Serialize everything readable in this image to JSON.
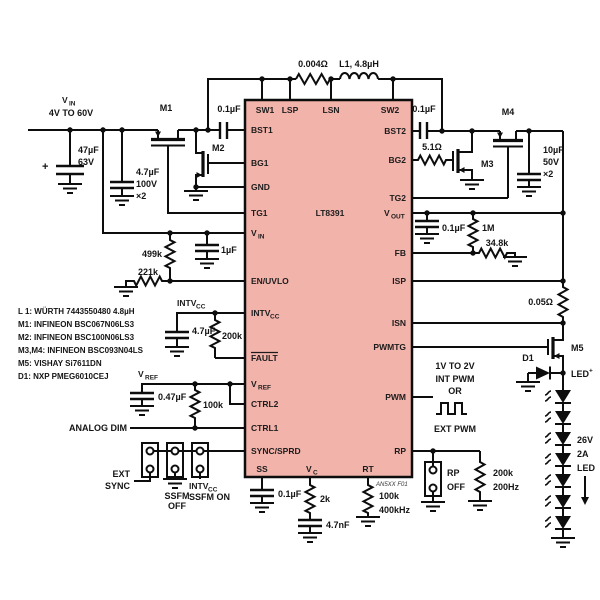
{
  "ic": {
    "part": "LT8391",
    "fig_ref": "AN5XX F01"
  },
  "pins": {
    "sw1": "SW1",
    "lsp": "LSP",
    "lsn": "LSN",
    "sw2": "SW2",
    "bst1": "BST1",
    "bg1": "BG1",
    "gnd": "GND",
    "tg1": "TG1",
    "vin": {
      "main": "V",
      "sub": "IN"
    },
    "en_uvlo": "EN/UVLO",
    "intvcc": {
      "main": "INTV",
      "sub": "CC"
    },
    "fault": "FAULT",
    "vref": {
      "main": "V",
      "sub": "REF"
    },
    "ctrl2": "CTRL2",
    "ctrl1": "CTRL1",
    "sync_sprd": "SYNC/SPRD",
    "ss": "SS",
    "vc": {
      "main": "V",
      "sub": "C"
    },
    "rt": "RT",
    "bst2": "BST2",
    "bg2": "BG2",
    "tg2": "TG2",
    "vout": {
      "main": "V",
      "sub": "OUT"
    },
    "fb": "FB",
    "isp": "ISP",
    "isn": "ISN",
    "pwmtg": "PWMTG",
    "pwm": "PWM",
    "rp": "RP"
  },
  "input": {
    "label": {
      "main": "V",
      "sub": "IN"
    },
    "range": "4V TO 60V"
  },
  "values": {
    "c_in_bulk": "47µF",
    "c_in_bulk_v": "63V",
    "c_in_bulk_plus": "+",
    "c_in_cer": "4.7µF",
    "c_in_cer_v": "100V",
    "c_in_cer_qty": "×2",
    "c_bst1": "0.1µF",
    "r_ind": "0.004Ω",
    "l1": "L1, 4.8µH",
    "c_bst2": "0.1µF",
    "r_bg2": "5.1Ω",
    "c_out": "10µF",
    "c_out_v": "50V",
    "c_out_qty": "×2",
    "r_en_top": "499k",
    "r_en_bot": "221k",
    "c_vin": "1µF",
    "c_intvcc": "4.7µF",
    "r_fault": "200k",
    "c_vref": "0.47µF",
    "r_ctrl": "100k",
    "c_vout": "0.1µF",
    "r_fb_top": "1M",
    "r_fb_bot": "34.8k",
    "r_isense": "0.05Ω",
    "c_ss": "0.1µF",
    "r_vc": "2k",
    "c_vc": "4.7nF",
    "r_rt": "100k",
    "r_rt_f": "400kHz",
    "r_rp": "200k",
    "r_rp_f": "200Hz"
  },
  "devices": {
    "m1": "M1",
    "m2": "M2",
    "m3": "M3",
    "m4": "M4",
    "m5": "M5",
    "d1": "D1"
  },
  "annotations": {
    "intvcc_node": {
      "main": "INTV",
      "sub": "CC"
    },
    "vref_node": {
      "main": "V",
      "sub": "REF"
    },
    "analog_dim": "ANALOG DIM",
    "ext_sync": [
      "EXT",
      "SYNC"
    ],
    "ssfm_off": [
      "SSFM",
      "OFF"
    ],
    "intvcc_jumper": {
      "main": "INTV",
      "sub": "CC"
    },
    "ssfm_on": "SSFM ON",
    "pwm_note": [
      "1V TO 2V",
      "INT PWM",
      "OR",
      "EXT PWM"
    ],
    "rp_off": [
      "RP",
      "OFF"
    ],
    "led_rating": [
      "26V",
      "2A",
      "LED"
    ],
    "led_plus": {
      "main": "LED",
      "sup": "+"
    }
  },
  "bom": [
    "L 1: WÜRTH 7443550480 4.8µH",
    "M1: INFINEON BSC067N06LS3",
    "M2: INFINEON BSC100N06LS3",
    "M3,M4: INFINEON BSC093N04LS",
    "M5: VISHAY Si7611DN",
    "D1: NXP PMEG6010CEJ"
  ],
  "colors": {
    "ic_fill": "#f2b3ab",
    "ic_border": "#0d0d0d",
    "wire": "#0d0d0d",
    "text": "#141414"
  }
}
